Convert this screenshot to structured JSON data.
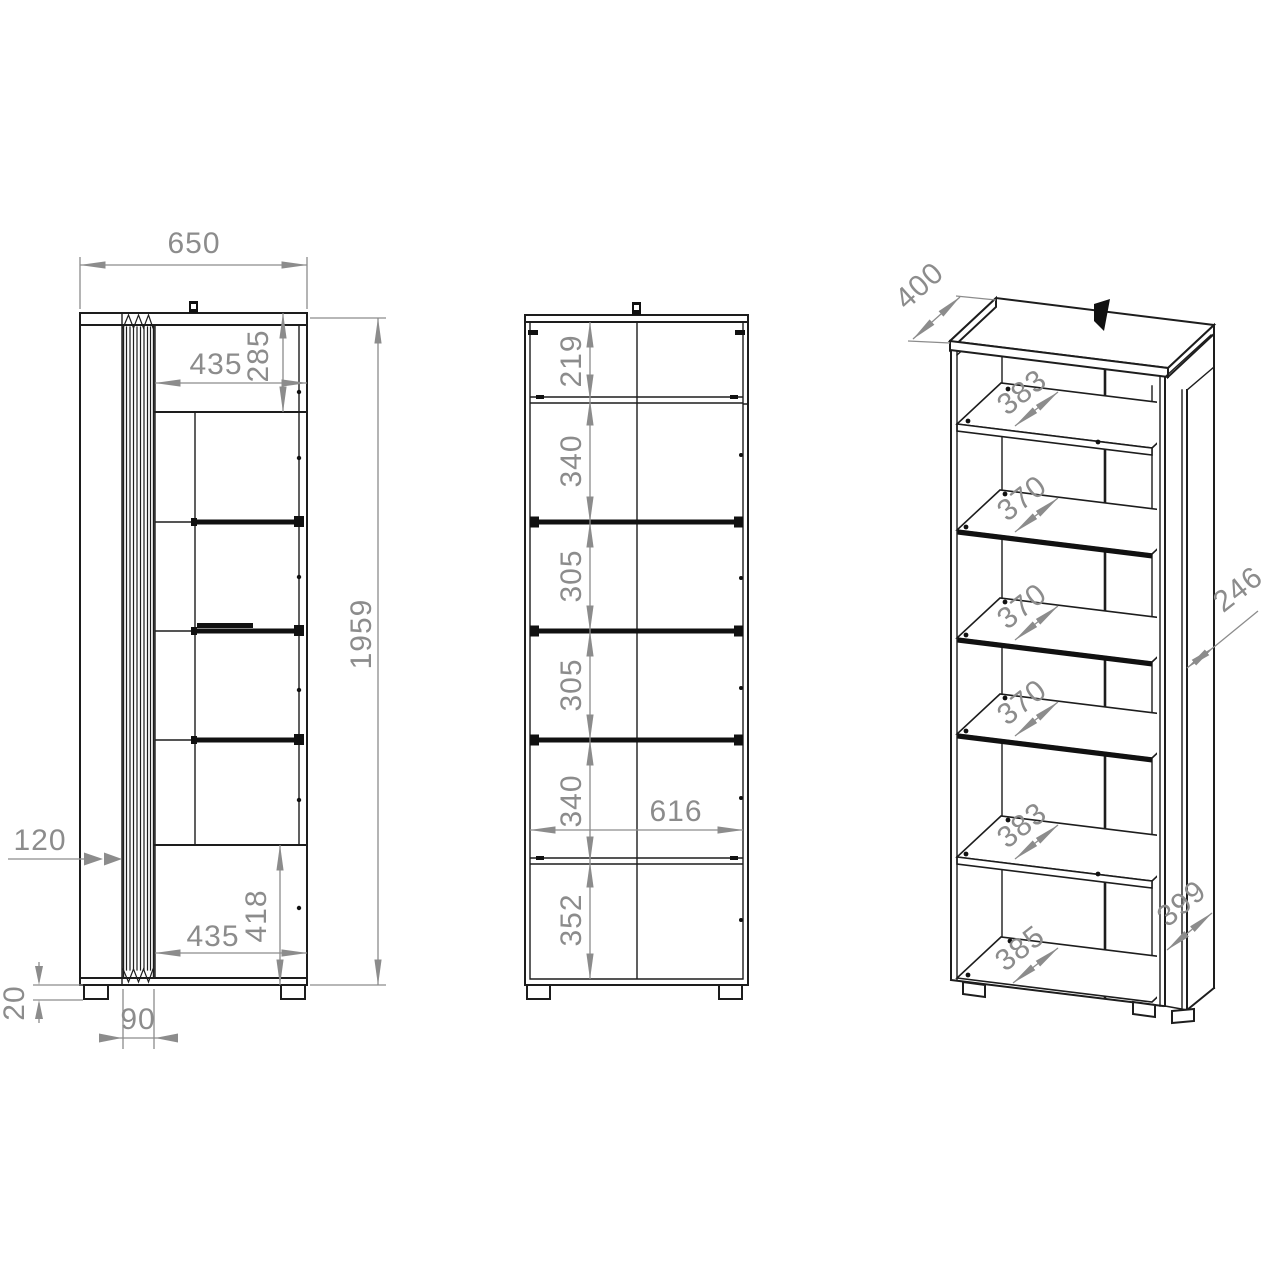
{
  "colors": {
    "line": "#1d1d1d",
    "dimension": "#8c8c8c",
    "background": "#ffffff"
  },
  "views": {
    "side": {
      "width": "650",
      "height": "1959",
      "top_compartment_width": "435",
      "top_compartment_height": "285",
      "front_panel_depth": "120",
      "bottom_compartment_width": "435",
      "bottom_compartment_height": "418",
      "foot_height": "20",
      "flute_strip_width": "90"
    },
    "front": {
      "sections": [
        "219",
        "340",
        "305",
        "305",
        "340",
        "352"
      ],
      "interior_width": "616"
    },
    "iso": {
      "top_depth": "400",
      "shelf_depths": [
        "383",
        "370",
        "370",
        "370",
        "383",
        "385"
      ],
      "side_panel_depth": "246",
      "plinth_panel_depth": "399"
    }
  }
}
